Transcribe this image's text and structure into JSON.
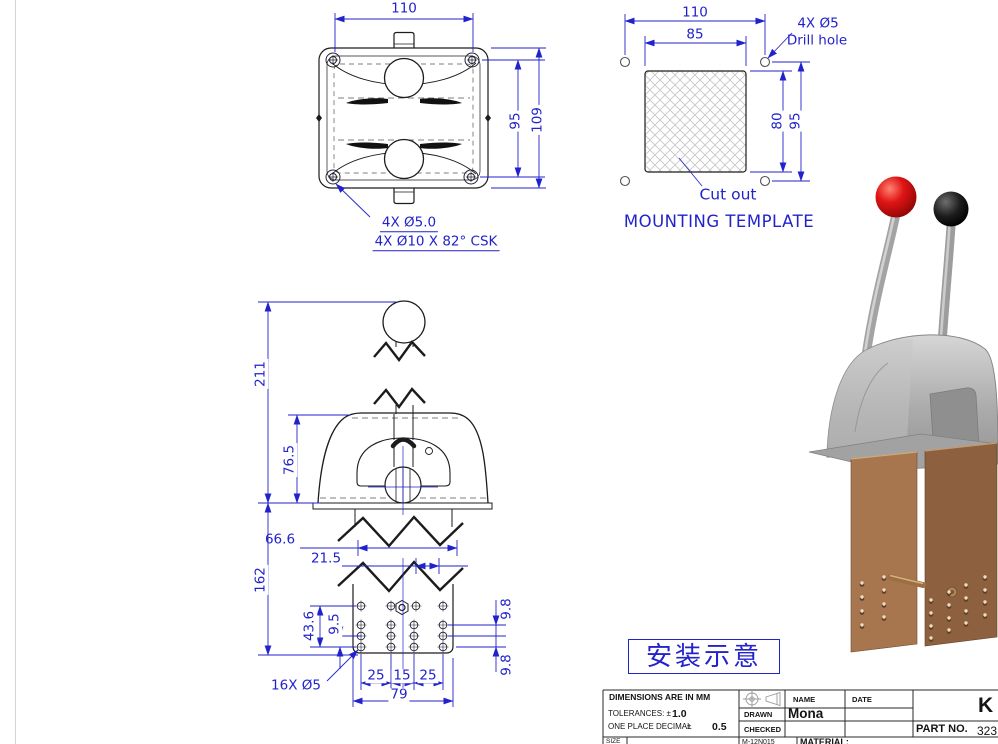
{
  "sheet": {
    "background": "#ffffff",
    "line_color": "#1c1c1c",
    "dim_color": "#2222cc"
  },
  "top_view": {
    "dim_width": "110",
    "dim_height_inner": "95",
    "dim_height_outer": "109",
    "note_holes": "4X Ø5.0",
    "note_csk": "4X Ø10 X 82° CSK"
  },
  "mounting_template": {
    "title": "MOUNTING TEMPLATE",
    "dim_width_holes": "110",
    "dim_width_cutout": "85",
    "dim_height_cutout": "80",
    "dim_height_holes": "95",
    "note_drill": "4X Ø5",
    "note_drill_hole": "Drill hole",
    "note_cutout": "Cut out"
  },
  "side_view": {
    "dim_total_height": "211",
    "dim_head_height": "76.5",
    "dim_lower_height": "162",
    "dim_66_6": "66.6",
    "dim_21_5": "21.5",
    "dim_43_6": "43.6",
    "dim_9_5": "9.5",
    "dim_9_8_top": "9.8",
    "dim_9_8_bottom": "9.8",
    "dim_25_left": "25",
    "dim_15": "15",
    "dim_25_right": "25",
    "dim_79": "79",
    "note_holes": "16X Ø5"
  },
  "installation_note": {
    "text": "安装示意"
  },
  "title_block": {
    "dimensions_note": "DIMENSIONS ARE IN MM",
    "tolerances_label": "TOLERANCES: ±",
    "tolerances_value": "1.0",
    "one_place_label": "ONE PLACE DECIMAL",
    "plus_minus": "±",
    "one_place_value": "0.5",
    "name_header": "NAME",
    "date_header": "DATE",
    "drawn_label": "DRAWN",
    "drawn_value": "Mona",
    "checked_label": "CHECKED",
    "drawing_letter": "K",
    "part_no_label": "PART NO.",
    "part_no_value": "323",
    "size_label": "SIZE",
    "doc_code": "M-12N015",
    "material_label": "MATERIAL:"
  },
  "render": {
    "knob_left_color": "#cc1111",
    "knob_right_color": "#111111",
    "body_color": "#a9a9a9",
    "bracket_color": "#a0714a"
  }
}
